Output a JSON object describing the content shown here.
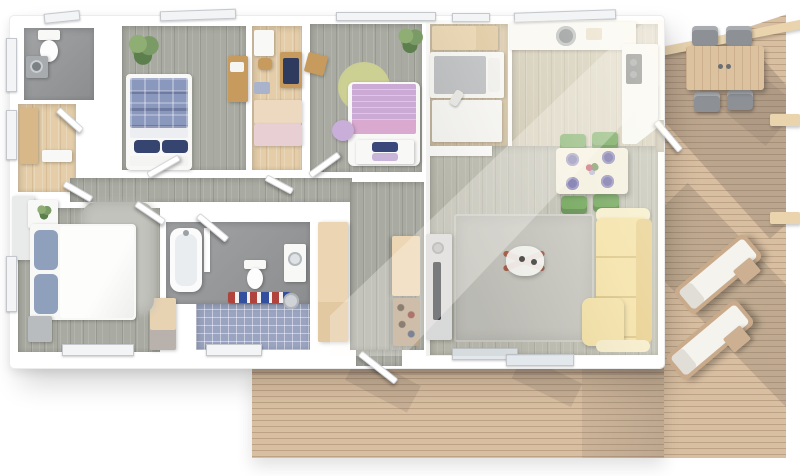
{
  "scene": {
    "type": "floor-plan-3d-render-top-view",
    "description": "Aerial 3D render of a single-storey house with wrap-around wooden deck on right and bottom",
    "rooms": [
      {
        "id": "wc",
        "label": "toilet room",
        "floor": "concrete",
        "items": [
          "toilet",
          "washing-machine"
        ]
      },
      {
        "id": "closet",
        "label": "walk-in closet",
        "floor": "beige-wood",
        "items": [
          "wardrobe",
          "door"
        ]
      },
      {
        "id": "bedroom-1",
        "label": "bedroom with blue plaid bed",
        "floor": "gray-wood",
        "items": [
          "double-bed-blue-plaid",
          "navy-pillows",
          "potted-plant",
          "wood-desk"
        ]
      },
      {
        "id": "office",
        "label": "study room",
        "floor": "beige-wood",
        "items": [
          "white-desk",
          "desk-chair",
          "desk-with-monitor",
          "wardrobe"
        ]
      },
      {
        "id": "bedroom-2",
        "label": "bedroom with purple bed",
        "floor": "gray-wood",
        "items": [
          "double-bed-purple",
          "foot-bench-with-pillows",
          "round-green-rug",
          "lilac-pouf",
          "wood-stool",
          "potted-plant"
        ]
      },
      {
        "id": "bedroom-3",
        "label": "small bedroom",
        "floor": "light-wood",
        "items": [
          "wardrobe",
          "single-bed",
          "desk"
        ]
      },
      {
        "id": "kitchen",
        "label": "kitchen",
        "floor": "light-wood",
        "items": [
          "counter-run",
          "round-sink",
          "cutting-board",
          "cooktop",
          "corner-counter"
        ]
      },
      {
        "id": "dining",
        "label": "dining area",
        "floor": "light-wood",
        "items": [
          "dining-table",
          "green-chair",
          "green-chair",
          "green-chair",
          "green-chair",
          "purple-plates",
          "flower-bouquet"
        ]
      },
      {
        "id": "living",
        "label": "living area",
        "floor": "light-wood",
        "items": [
          "gray-area-rug",
          "coffee-table",
          "yellow-corner-sofa",
          "tv-sideboard",
          "tv"
        ]
      },
      {
        "id": "hallway",
        "label": "entrance hall",
        "floor": "gray-wood",
        "items": [
          "wardrobe-left",
          "wardrobe-right",
          "shoe-rack",
          "entry-door"
        ]
      },
      {
        "id": "bathroom",
        "label": "bathroom",
        "floor": "concrete-and-blue-tile",
        "items": [
          "bathtub",
          "toilet",
          "washbasin-vanity",
          "towel-rail",
          "laundry-basket",
          "bath-mat"
        ]
      },
      {
        "id": "master-bedroom",
        "label": "master bedroom",
        "floor": "gray-wood",
        "items": [
          "double-bed-white",
          "blue-pillows",
          "fluffy-gray-rug",
          "nightstand-with-plant",
          "wardrobe",
          "dresser"
        ]
      }
    ],
    "outdoor": {
      "label": "wooden deck terrace",
      "items": [
        "outdoor-dining-table",
        "outdoor-chair",
        "outdoor-chair",
        "outdoor-chair",
        "outdoor-chair",
        "sun-lounger",
        "sun-lounger",
        "side-table",
        "side-table",
        "pergola-beam-diagonal",
        "pergola-beam",
        "pergola-beam"
      ]
    },
    "counts": {
      "bedrooms": 4,
      "bathrooms": 2,
      "deck_sections": 2,
      "sun_loungers": 2,
      "dining_chairs_inside": 4,
      "dining_chairs_outside": 4
    }
  },
  "colors": {
    "wall": "#ffffff",
    "floor_gray": "#a9aba2",
    "floor_living": "#bcbcb0",
    "floor_kitchen": "#cfc8b4",
    "floor_beige": "#e4cda8",
    "floor_lightwood": "#d9c7a7",
    "concrete": "#97999b",
    "tile": "#9aa3bf",
    "deck": "#d8bfa2",
    "beam": "#e9d4ae",
    "bed_blue": "#8b98bd",
    "navy": "#36456f",
    "bed_purple": "#cbaad6",
    "pink_blanket": "#d9a9cf",
    "lilac": "#c9aed9",
    "rug_green": "#c6c78f",
    "sofa": "#f3dfa0",
    "sofa_dark": "#e6cb85",
    "chair_green": "#5f9c49",
    "plate_purple": "#6c68a6",
    "rug_gray": "#c3c3bd",
    "wood": "#c79a5e",
    "appliance": "#a7abae",
    "tv": "#3a3f46",
    "towel_red": "#b0433c",
    "towel_blue": "#33509e",
    "plant": "#7b9b66"
  }
}
